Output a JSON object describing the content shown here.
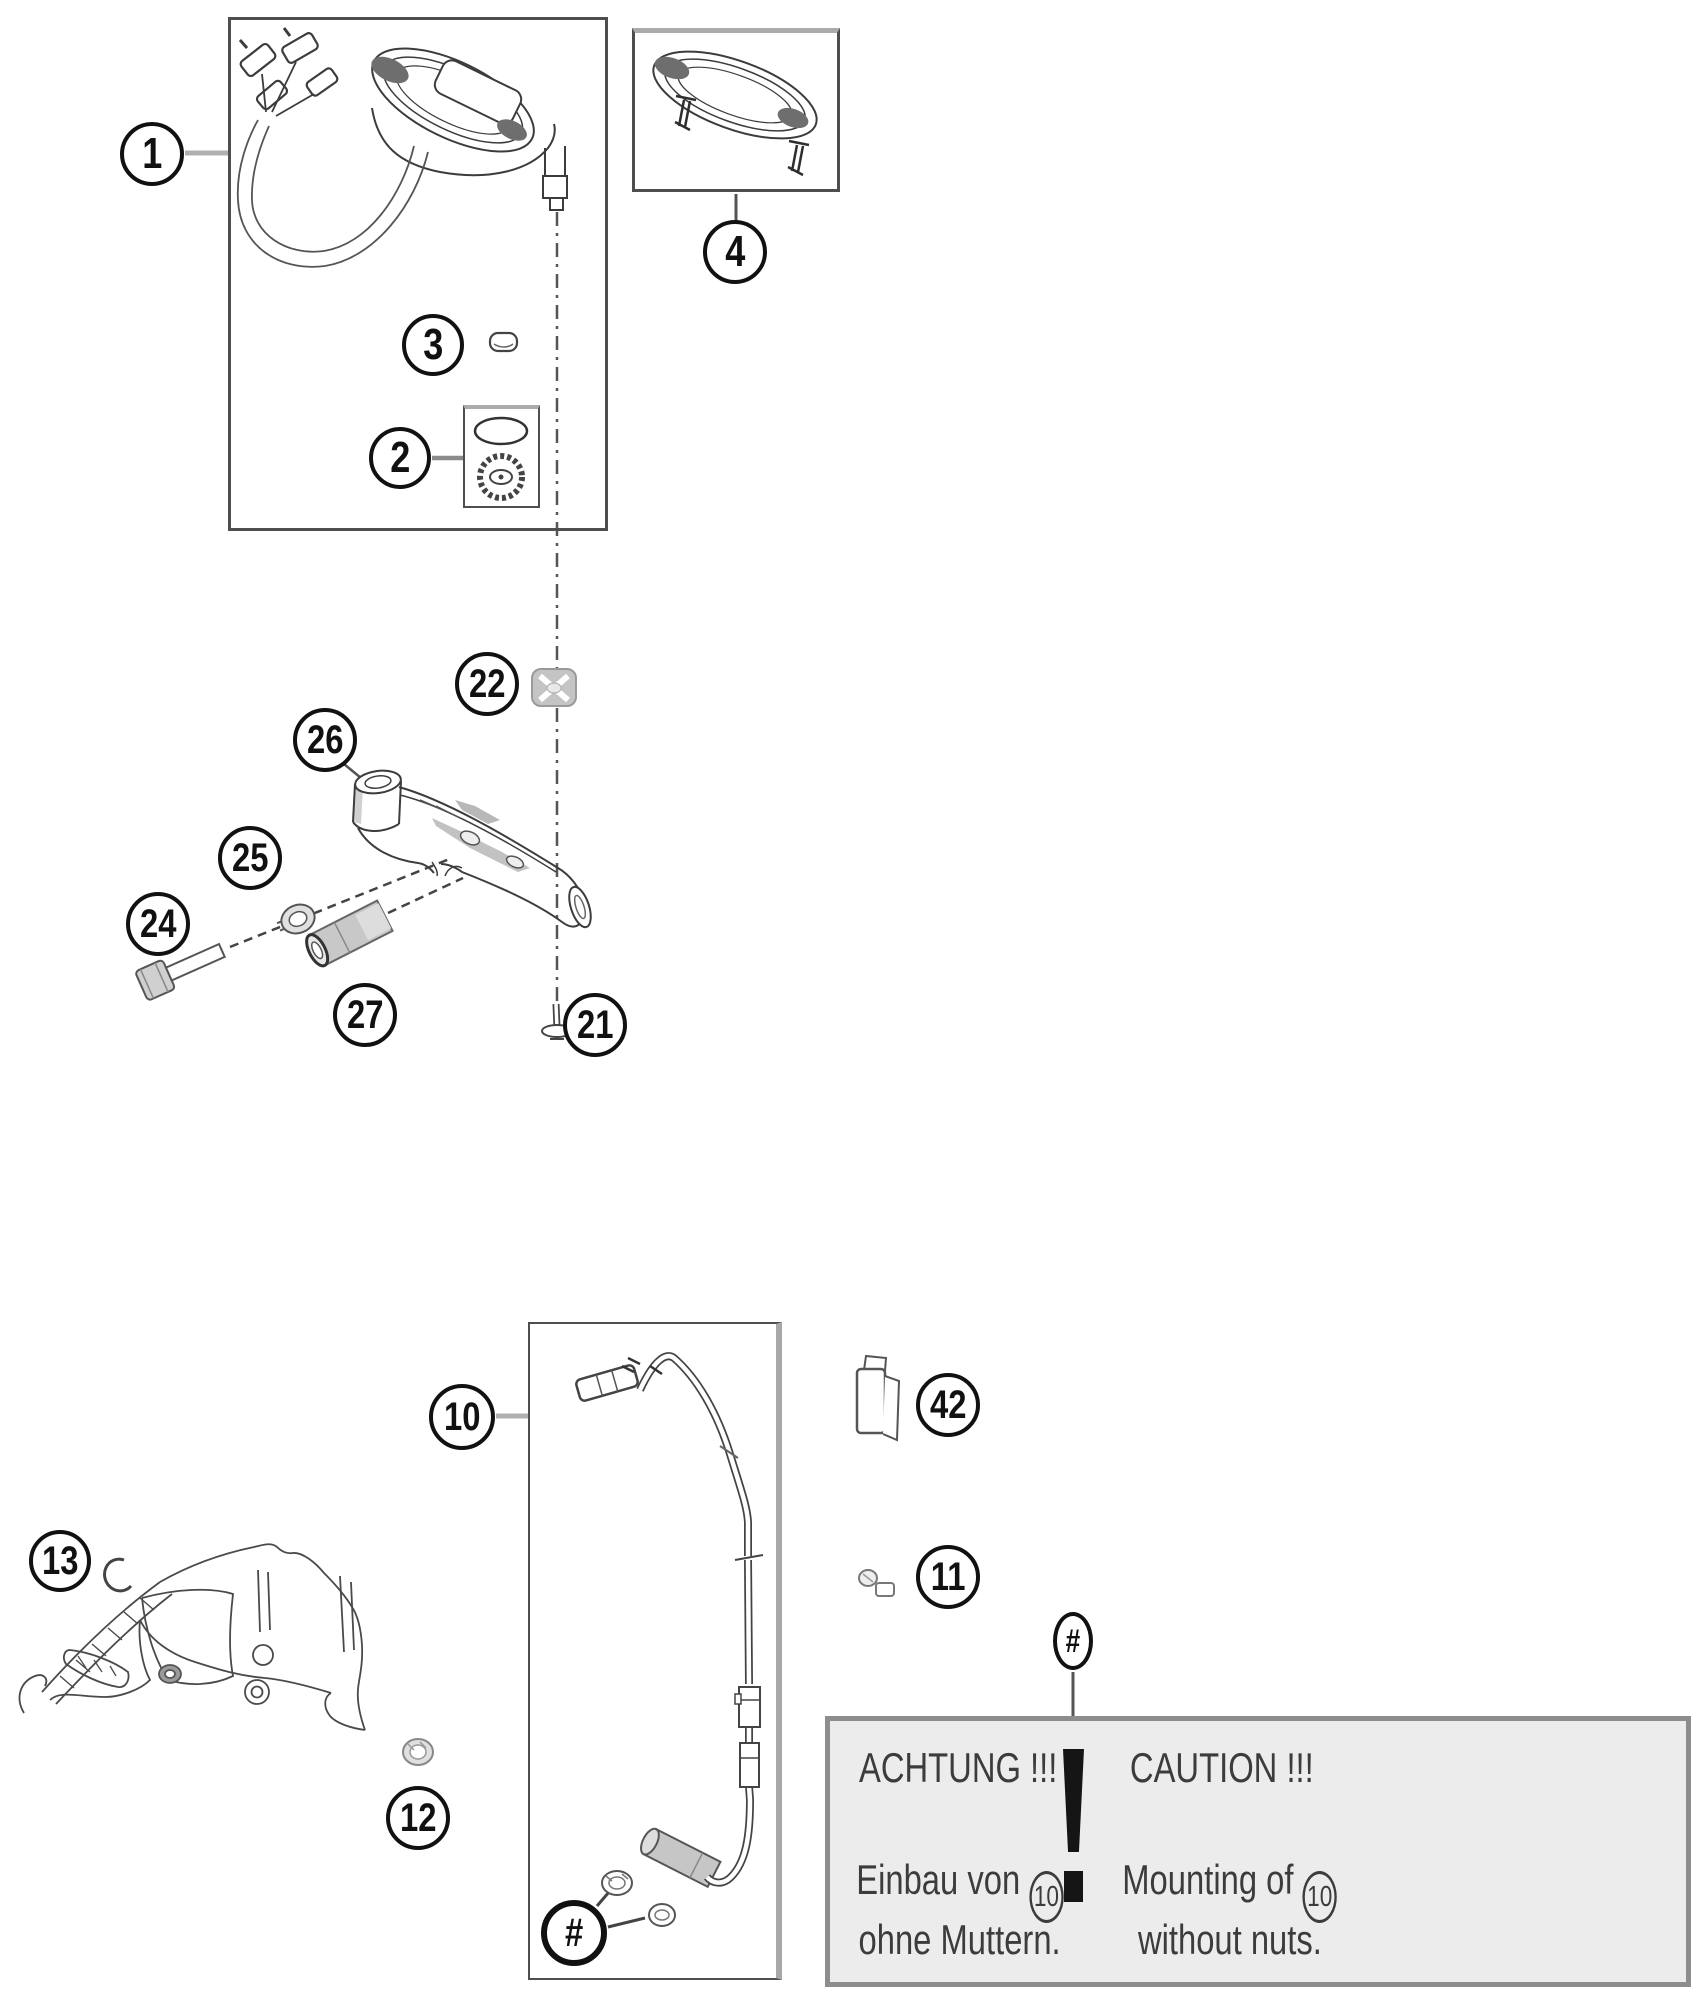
{
  "title": "Instruments / speedometer exploded parts diagram",
  "callouts": [
    {
      "label": "1"
    },
    {
      "label": "2"
    },
    {
      "label": "3"
    },
    {
      "label": "4"
    },
    {
      "label": "22"
    },
    {
      "label": "26"
    },
    {
      "label": "25"
    },
    {
      "label": "24"
    },
    {
      "label": "27"
    },
    {
      "label": "21"
    },
    {
      "label": "10"
    },
    {
      "label": "42"
    },
    {
      "label": "11"
    },
    {
      "label": "13"
    },
    {
      "label": "12"
    },
    {
      "label": "#"
    },
    {
      "label": "#"
    }
  ],
  "caution": {
    "de": {
      "title": "ACHTUNG !!!",
      "line1_prefix": "Einbau von",
      "part_ref": "10",
      "line2": "ohne Muttern."
    },
    "en": {
      "title": "CAUTION !!!",
      "line1_prefix": "Mounting of",
      "part_ref": "10",
      "line2": "without nuts."
    }
  },
  "colors": {
    "line": "#3c3c3c",
    "leader_gray": "#b0b0b0",
    "part_gray": "#c6c6c6",
    "caution_bg": "#ececec",
    "caution_border": "#8d8d8d"
  }
}
